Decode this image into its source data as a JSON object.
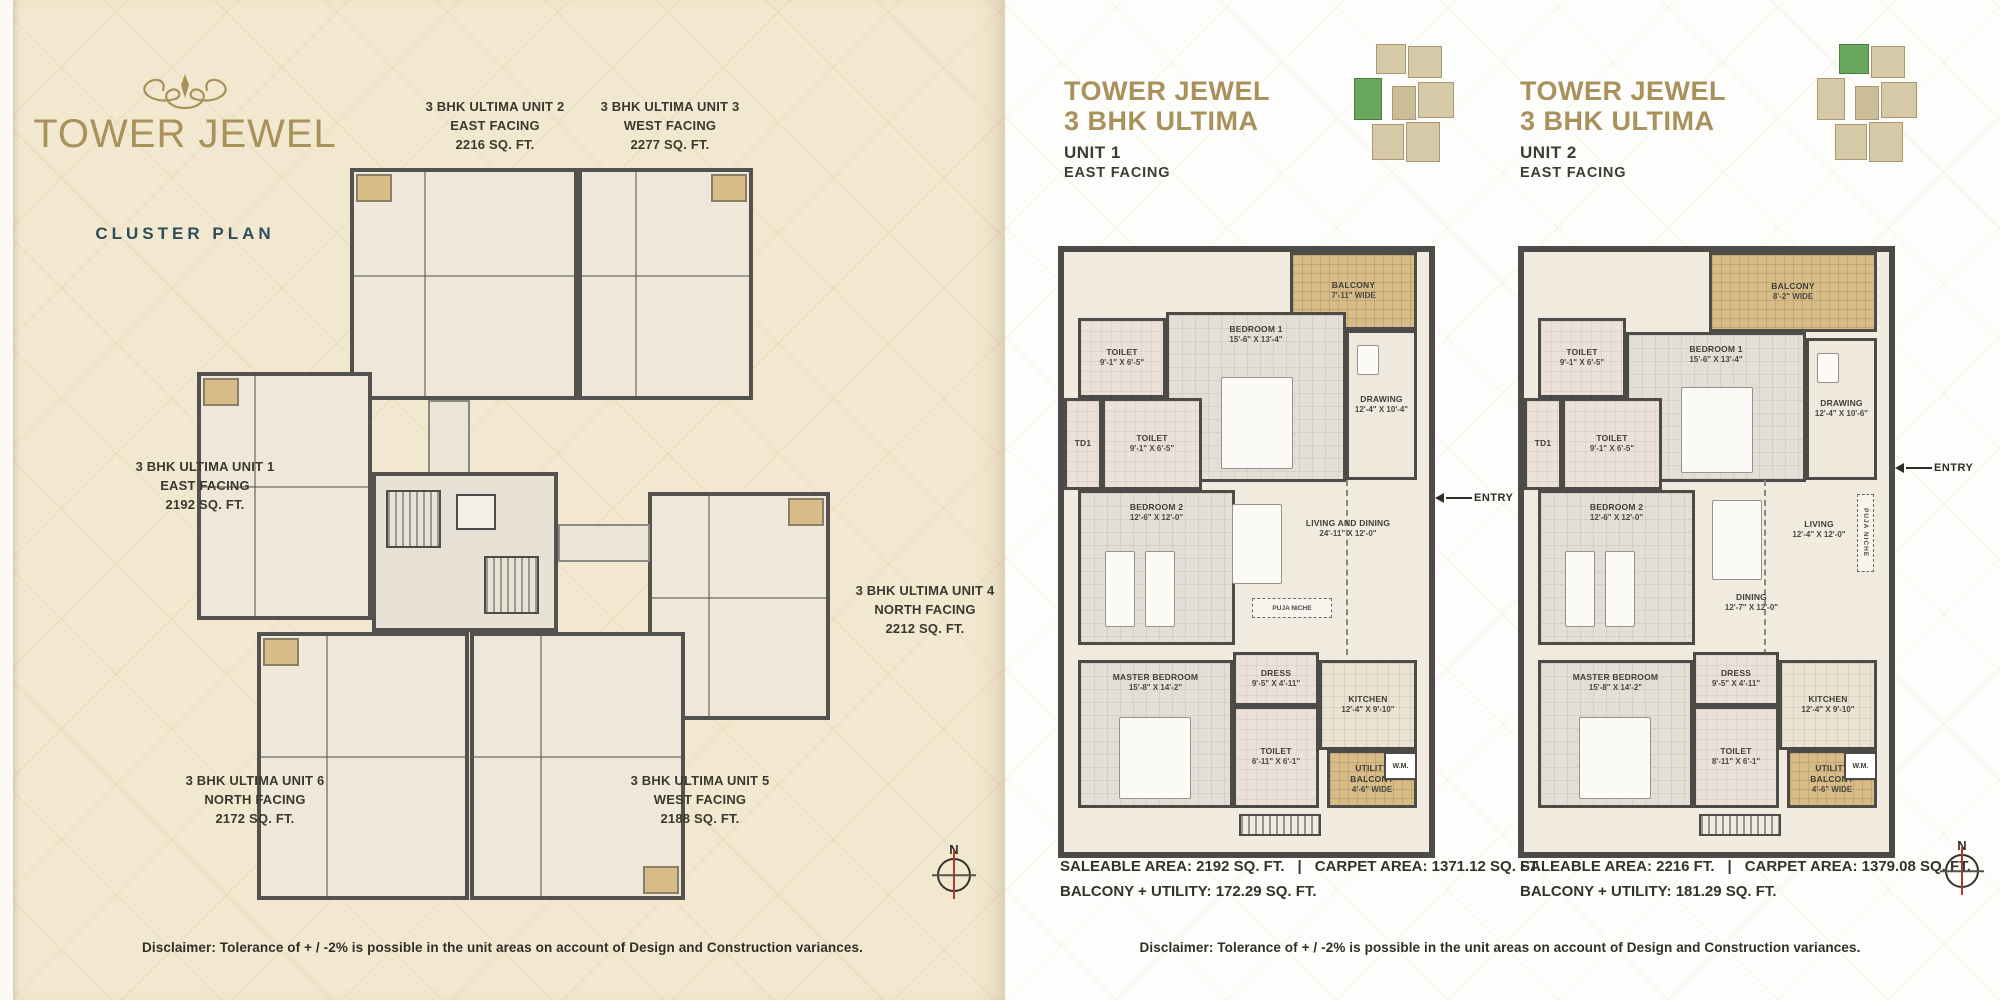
{
  "colors": {
    "gold": "#a8915a",
    "teal": "#2e4d59",
    "cream_background": "#f2e8cf",
    "wall_dark": "#4c4b47",
    "balcony_tan": "#d8bc88",
    "keyplan_highlight_green": "#69a75e",
    "compass_needle_red": "#b03a2e"
  },
  "cluster_panel": {
    "title": "TOWER JEWEL",
    "subtitle": "CLUSTER PLAN",
    "ornament_icon": "flourish-icon",
    "unit_labels": [
      {
        "line1": "3 BHK ULTIMA UNIT 1",
        "line2": "EAST FACING",
        "line3": "2192 SQ. FT."
      },
      {
        "line1": "3 BHK ULTIMA UNIT 2",
        "line2": "EAST FACING",
        "line3": "2216 SQ. FT."
      },
      {
        "line1": "3 BHK ULTIMA UNIT 3",
        "line2": "WEST FACING",
        "line3": "2277 SQ. FT."
      },
      {
        "line1": "3 BHK ULTIMA UNIT 4",
        "line2": "NORTH FACING",
        "line3": "2212 SQ. FT."
      },
      {
        "line1": "3 BHK ULTIMA UNIT 5",
        "line2": "WEST FACING",
        "line3": "2188 SQ. FT."
      },
      {
        "line1": "3 BHK ULTIMA UNIT 6",
        "line2": "NORTH FACING",
        "line3": "2172 SQ. FT."
      }
    ],
    "compass_label": "N",
    "disclaimer": "Disclaimer: Tolerance of + / -2% is possible in the unit areas on account of Design and Construction variances."
  },
  "unit_plans": [
    {
      "brand_line1": "TOWER JEWEL",
      "brand_line2": "3 BHK ULTIMA",
      "unit_label": "UNIT 1",
      "facing": "EAST FACING",
      "rooms": {
        "balcony": {
          "name": "BALCONY",
          "dim": "7'-11\" WIDE"
        },
        "toilet1": {
          "name": "TOILET",
          "dim": "9'-1\" X 6'-5\""
        },
        "bedroom1": {
          "name": "BEDROOM 1",
          "dim": "15'-6\" X 13'-4\""
        },
        "drawing": {
          "name": "DRAWING",
          "dim": "12'-4\" X 10'-4\""
        },
        "td1": {
          "name": "TD1"
        },
        "toilet2": {
          "name": "TOILET",
          "dim": "9'-1\" X 6'-5\""
        },
        "bedroom2": {
          "name": "BEDROOM 2",
          "dim": "12'-6\" X 12'-0\""
        },
        "living_dining": {
          "name": "LIVING AND DINING",
          "dim": "24'-11\" X 12'-0\""
        },
        "puja": {
          "name": "PUJA NICHE"
        },
        "entry": {
          "name": "ENTRY"
        },
        "dress": {
          "name": "DRESS",
          "dim": "9'-5\" X 4'-11\""
        },
        "master_bedroom": {
          "name": "MASTER BEDROOM",
          "dim": "15'-8\" X 14'-2\""
        },
        "toilet3": {
          "name": "TOILET",
          "dim": "6'-11\" X 6'-1\""
        },
        "kitchen": {
          "name": "KITCHEN",
          "dim": "12'-4\" X 9'-10\""
        },
        "utility": {
          "name": "UTILITY BALCONY",
          "dim": "4'-6\" WIDE"
        },
        "wm": {
          "name": "W.M."
        }
      },
      "stats": {
        "saleable": "SALEABLE AREA: 2192 SQ. FT.",
        "divider": "|",
        "carpet": "CARPET AREA: 1371.12 SQ. FT.",
        "balcony_utility": "BALCONY + UTILITY: 172.29 SQ. FT."
      }
    },
    {
      "brand_line1": "TOWER JEWEL",
      "brand_line2": "3 BHK ULTIMA",
      "unit_label": "UNIT 2",
      "facing": "EAST FACING",
      "rooms": {
        "balcony": {
          "name": "BALCONY",
          "dim": "8'-2\" WIDE"
        },
        "toilet1": {
          "name": "TOILET",
          "dim": "9'-1\" X 6'-5\""
        },
        "bedroom1": {
          "name": "BEDROOM 1",
          "dim": "15'-6\" X 13'-4\""
        },
        "drawing": {
          "name": "DRAWING",
          "dim": "12'-4\" X 10'-6\""
        },
        "td1": {
          "name": "TD1"
        },
        "toilet2": {
          "name": "TOILET",
          "dim": "9'-1\" X 6'-5\""
        },
        "bedroom2": {
          "name": "BEDROOM 2",
          "dim": "12'-6\" X 12'-0\""
        },
        "dining": {
          "name": "DINING",
          "dim": "12'-7\" X 12'-0\""
        },
        "living": {
          "name": "LIVING",
          "dim": "12'-4\" X 12'-0\""
        },
        "puja": {
          "name": "PUJA NICHE"
        },
        "entry": {
          "name": "ENTRY"
        },
        "dress": {
          "name": "DRESS",
          "dim": "9'-5\" X 4'-11\""
        },
        "master_bedroom": {
          "name": "MASTER BEDROOM",
          "dim": "15'-8\" X 14'-2\""
        },
        "toilet3": {
          "name": "TOILET",
          "dim": "8'-11\" X 6'-1\""
        },
        "kitchen": {
          "name": "KITCHEN",
          "dim": "12'-4\" X 9'-10\""
        },
        "utility": {
          "name": "UTILITY BALCONY",
          "dim": "4'-6\" WIDE"
        },
        "wm": {
          "name": "W.M."
        }
      },
      "stats": {
        "saleable": "SALEABLE AREA: 2216 FT.",
        "divider": "|",
        "carpet": "CARPET AREA: 1379.08 SQ. FT.",
        "balcony_utility": "BALCONY + UTILITY: 181.29 SQ. FT."
      }
    }
  ],
  "right_panel": {
    "compass_label": "N",
    "disclaimer": "Disclaimer: Tolerance of + / -2% is possible in the unit areas on account of Design and Construction variances."
  }
}
